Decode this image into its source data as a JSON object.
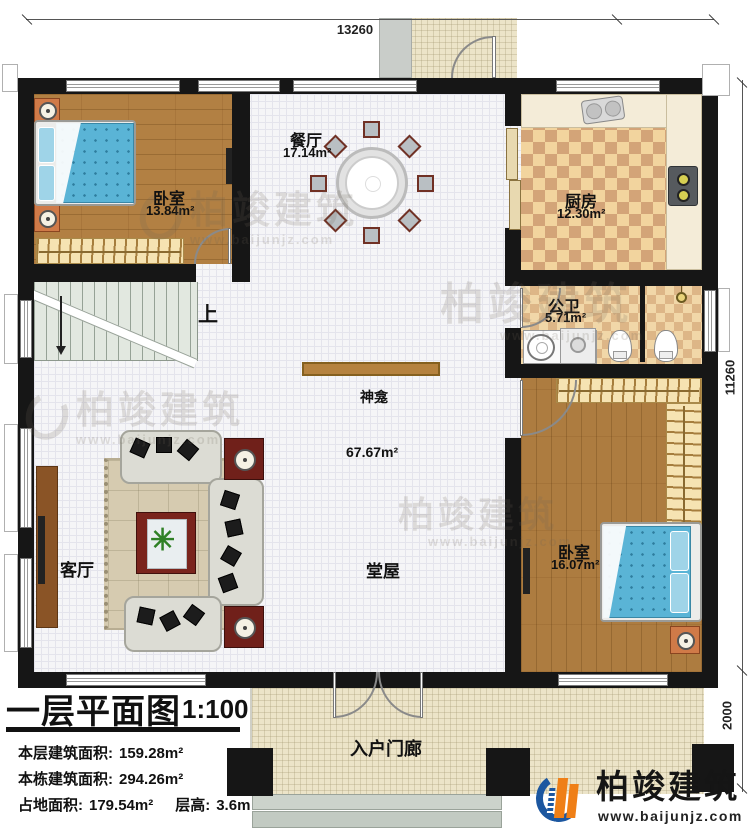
{
  "dimensions": {
    "width_total": "13260",
    "depth_main": "11260",
    "porch_depth": "2000"
  },
  "rooms": {
    "bedroom1": {
      "name": "卧室",
      "area": "13.84m²"
    },
    "dining": {
      "name": "餐厅",
      "area": "17.14m²"
    },
    "kitchen": {
      "name": "厨房",
      "area": "12.30m²"
    },
    "bathroom": {
      "name": "公卫",
      "area": "5.71m²"
    },
    "bedroom2": {
      "name": "卧室",
      "area": "16.07m²"
    },
    "living": {
      "name": "客厅"
    },
    "hall": {
      "name": "堂屋",
      "area": "67.67m²"
    },
    "shrine": {
      "name": "神龛"
    },
    "stairs": {
      "up_label": "上"
    },
    "entry_porch": {
      "name": "入户门廊"
    }
  },
  "title_block": {
    "plan_title": "一层平面图",
    "scale": "1:100",
    "floor_area_label": "本层建筑面积:",
    "floor_area_value": "159.28m²",
    "total_area_label": "本栋建筑面积:",
    "total_area_value": "294.26m²",
    "footprint_label": "占地面积:",
    "footprint_value": "179.54m²",
    "story_height_label": "层高:",
    "story_height_value": "3.6m"
  },
  "branding": {
    "company": "柏竣建筑",
    "website": "www.baijunjz.com",
    "blue": "#1c57a0",
    "orange": "#ef7f17"
  },
  "icons": {
    "plant": "✳"
  }
}
